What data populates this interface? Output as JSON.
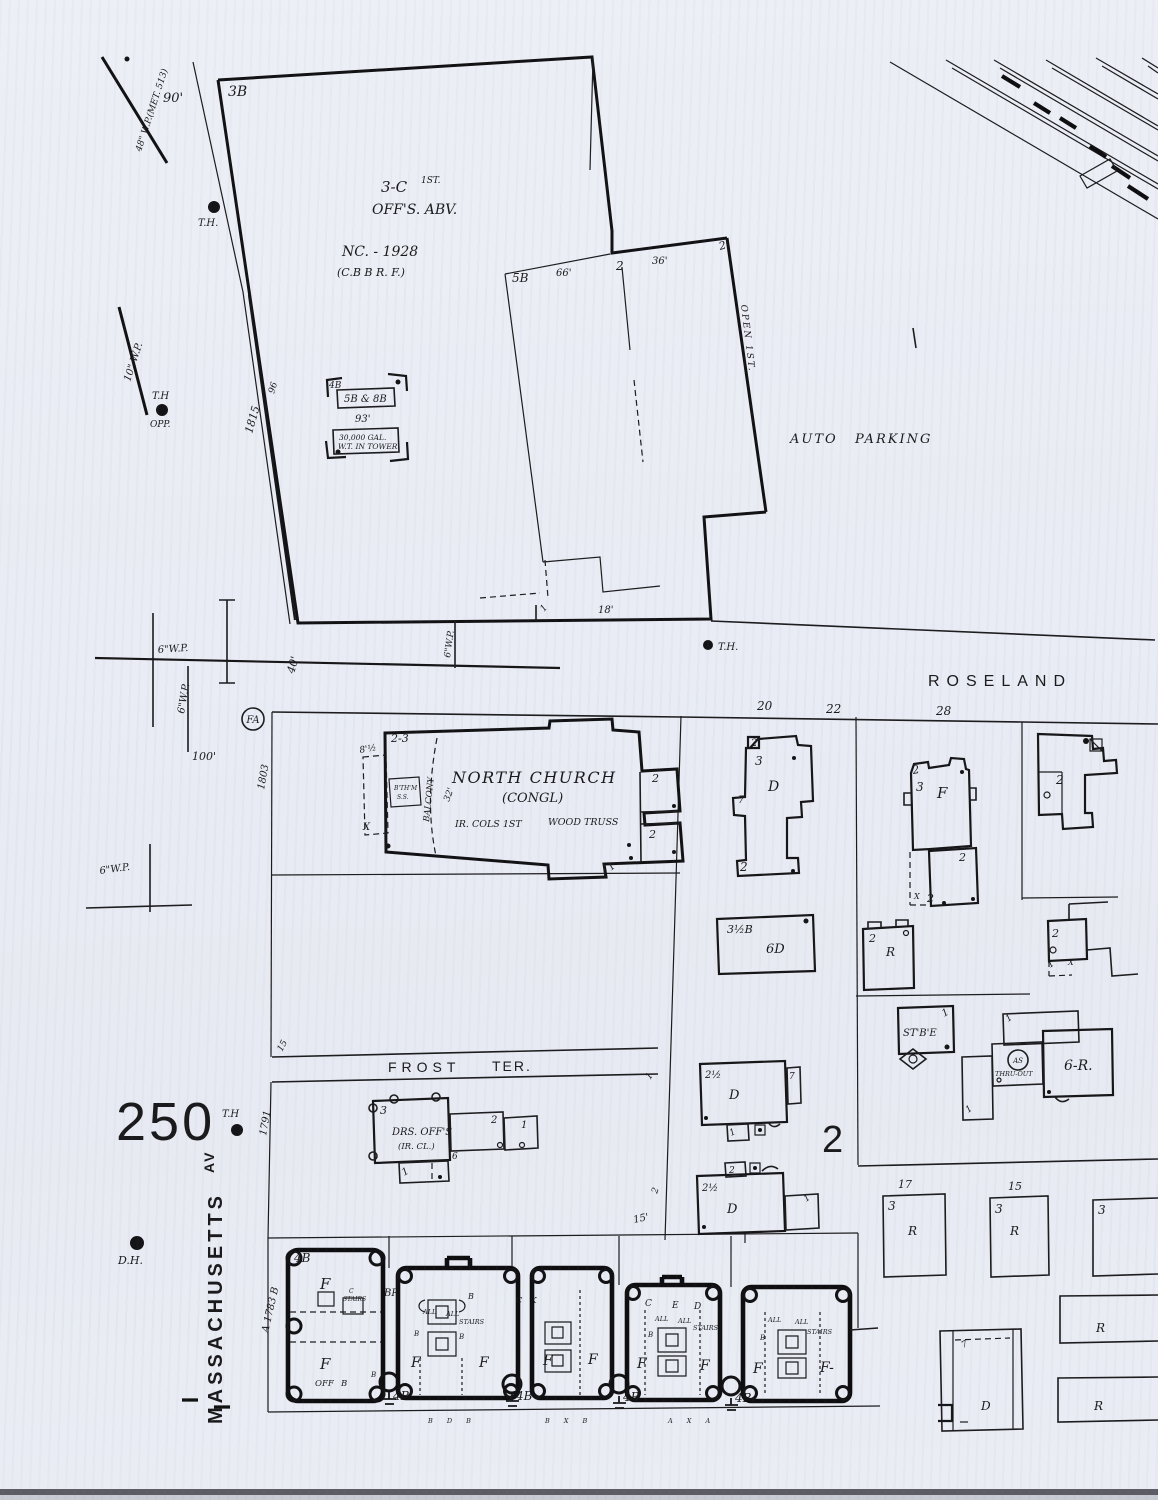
{
  "colors": {
    "paper": "#eaedf4",
    "ink": "#1a1a1c"
  },
  "glyphs": {
    "f": "F",
    "f_dash": "F-",
    "b4": "4B",
    "b": "B",
    "all": "ALL",
    "stairs": "STAIRS",
    "n1": "1",
    "n2": "2",
    "n3": "3",
    "n7": "7",
    "d": "D",
    "r": "R",
    "x": "X",
    "th": "T.H.",
    "wp6": "6\"W.P."
  },
  "top": {
    "wp48": "48\" W.P.(MET. 513)",
    "d90": "90'",
    "b3b": "3B",
    "c3": "3-C",
    "c3_sup": "1ST.",
    "offs_abv": "OFF'S. ABV.",
    "nc_1928": "NC. - 1928",
    "cbbrf": "(C.B B R. F.)",
    "wp10": "10\" W.P.",
    "th": "T.H",
    "opp": "OPP.",
    "s1815": "1815",
    "s96": "96",
    "b5b": "5B",
    "d66": "66'",
    "d36": "36'",
    "open_1st": "OPEN 1ST.",
    "d18": "18'"
  },
  "tower": {
    "b4": "4B",
    "b5b8b": "5B & 8B",
    "d93": "93'",
    "gal": "30,000 GAL.",
    "wt": "W.T. IN TOWER"
  },
  "parking": {
    "auto": "AUTO",
    "parking": "PARKING"
  },
  "roseland": {
    "name": "ROSELAND",
    "d40": "40'",
    "fa": "FA",
    "d100": "100'",
    "s1803": "1803",
    "h20": "20",
    "h22": "22",
    "h28": "28"
  },
  "church": {
    "floors": "2-3",
    "d8h": "8'½",
    "bsmt1": "B'TH'M",
    "bsmt2": "S.S.",
    "balcony": "BALCONY",
    "d32": "32'",
    "name": "NORTH CHURCH",
    "congl": "(CONGL)",
    "ir_cols": "IR. COLS 1ST",
    "truss": "WOOD TRUSS"
  },
  "bldg_6d": {
    "cls": "3½B",
    "label": "6D"
  },
  "stable": {
    "label": "ST'B'E"
  },
  "gas": {
    "circle": "AS",
    "note": "THRU-OUT",
    "r6": "6-R."
  },
  "frost": {
    "name": "FROST",
    "ter": "TER.",
    "n15": "15",
    "d15": "15'",
    "sheet": "250",
    "s1791": "1791",
    "drs": "DRS. OFF'S",
    "ir_cl": "(IR. CL.)",
    "n6": "6",
    "th": "T.H"
  },
  "block2": {
    "d25": "2½",
    "big2": "2"
  },
  "lower_right": {
    "h17": "17",
    "h15": "15"
  },
  "mass": {
    "name": "MASSACHUSETTS",
    "av": "AV",
    "dh": "D.H.",
    "a1783b": "A 1783 B"
  },
  "apartments": {
    "off": "OFF",
    "br": "BR",
    "c": "C",
    "ck": "C K",
    "e": "E",
    "tb1": "B D B",
    "tb2": "B X B",
    "tb3": "A X A"
  }
}
